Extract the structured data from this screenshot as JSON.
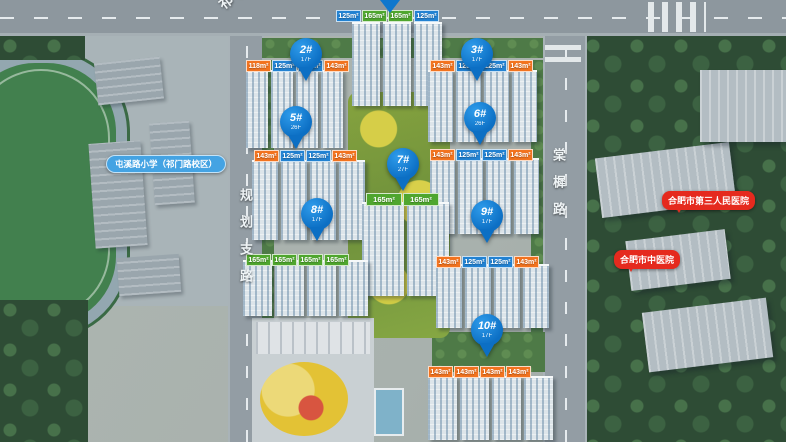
{
  "roads": {
    "top": {
      "name": "祁门路"
    },
    "left": {
      "name": "规划支路"
    },
    "right": {
      "name": "棠樨路"
    }
  },
  "pois": {
    "school": {
      "label": "屯溪路小学（祁门路校区）"
    },
    "hospital_third": {
      "label": "合肥市第三人民医院"
    },
    "hospital_tcm": {
      "label": "合肥市中医院"
    }
  },
  "pins": [
    {
      "id": "2#",
      "floors": "17F",
      "x": 290,
      "y": 38
    },
    {
      "id": "3#",
      "floors": "17F",
      "x": 461,
      "y": 38
    },
    {
      "id": "5#",
      "floors": "26F",
      "x": 280,
      "y": 106
    },
    {
      "id": "6#",
      "floors": "26F",
      "x": 464,
      "y": 102
    },
    {
      "id": "7#",
      "floors": "27F",
      "x": 387,
      "y": 148
    },
    {
      "id": "8#",
      "floors": "17F",
      "x": 301,
      "y": 198
    },
    {
      "id": "9#",
      "floors": "17F",
      "x": 471,
      "y": 200
    },
    {
      "id": "10#",
      "floors": "17F",
      "x": 471,
      "y": 314
    }
  ],
  "unit_rows": [
    {
      "x": 336,
      "y": 10,
      "wide": false,
      "chips": [
        {
          "label": "125m²",
          "color": "blue"
        },
        {
          "label": "165m²",
          "color": "green"
        },
        {
          "label": "165m²",
          "color": "green"
        },
        {
          "label": "125m²",
          "color": "blue"
        }
      ]
    },
    {
      "x": 246,
      "y": 60,
      "wide": false,
      "chips": [
        {
          "label": "118m²",
          "color": "orange"
        },
        {
          "label": "125m²",
          "color": "blue"
        },
        {
          "label": "125m²",
          "color": "blue"
        },
        {
          "label": "143m²",
          "color": "orange"
        }
      ]
    },
    {
      "x": 430,
      "y": 60,
      "wide": false,
      "chips": [
        {
          "label": "143m²",
          "color": "orange"
        },
        {
          "label": "125m²",
          "color": "blue"
        },
        {
          "label": "125m²",
          "color": "blue"
        },
        {
          "label": "143m²",
          "color": "orange"
        }
      ]
    },
    {
      "x": 254,
      "y": 150,
      "wide": false,
      "chips": [
        {
          "label": "143m²",
          "color": "orange"
        },
        {
          "label": "125m²",
          "color": "blue"
        },
        {
          "label": "125m²",
          "color": "blue"
        },
        {
          "label": "143m²",
          "color": "orange"
        }
      ]
    },
    {
      "x": 430,
      "y": 149,
      "wide": false,
      "chips": [
        {
          "label": "143m²",
          "color": "orange"
        },
        {
          "label": "125m²",
          "color": "blue"
        },
        {
          "label": "125m²",
          "color": "blue"
        },
        {
          "label": "143m²",
          "color": "orange"
        }
      ]
    },
    {
      "x": 366,
      "y": 193,
      "wide": true,
      "chips": [
        {
          "label": "165m²",
          "color": "green"
        },
        {
          "label": "165m²",
          "color": "green"
        }
      ]
    },
    {
      "x": 246,
      "y": 254,
      "wide": false,
      "chips": [
        {
          "label": "165m²",
          "color": "green"
        },
        {
          "label": "165m²",
          "color": "green"
        },
        {
          "label": "165m²",
          "color": "green"
        },
        {
          "label": "165m²",
          "color": "green"
        }
      ]
    },
    {
      "x": 436,
      "y": 256,
      "wide": false,
      "chips": [
        {
          "label": "143m²",
          "color": "orange"
        },
        {
          "label": "125m²",
          "color": "blue"
        },
        {
          "label": "125m²",
          "color": "blue"
        },
        {
          "label": "143m²",
          "color": "orange"
        }
      ]
    },
    {
      "x": 428,
      "y": 366,
      "wide": false,
      "chips": [
        {
          "label": "143m²",
          "color": "orange"
        },
        {
          "label": "143m²",
          "color": "orange"
        },
        {
          "label": "143m²",
          "color": "orange"
        },
        {
          "label": "143m²",
          "color": "orange"
        }
      ]
    }
  ],
  "colors": {
    "pin_blue": "#0f77cd",
    "chip_blue": "#2282d2",
    "chip_green": "#4fa62e",
    "chip_orange": "#f2731f",
    "poi_red": "#e52a1e",
    "poi_school_blue": "#44a3e3"
  }
}
